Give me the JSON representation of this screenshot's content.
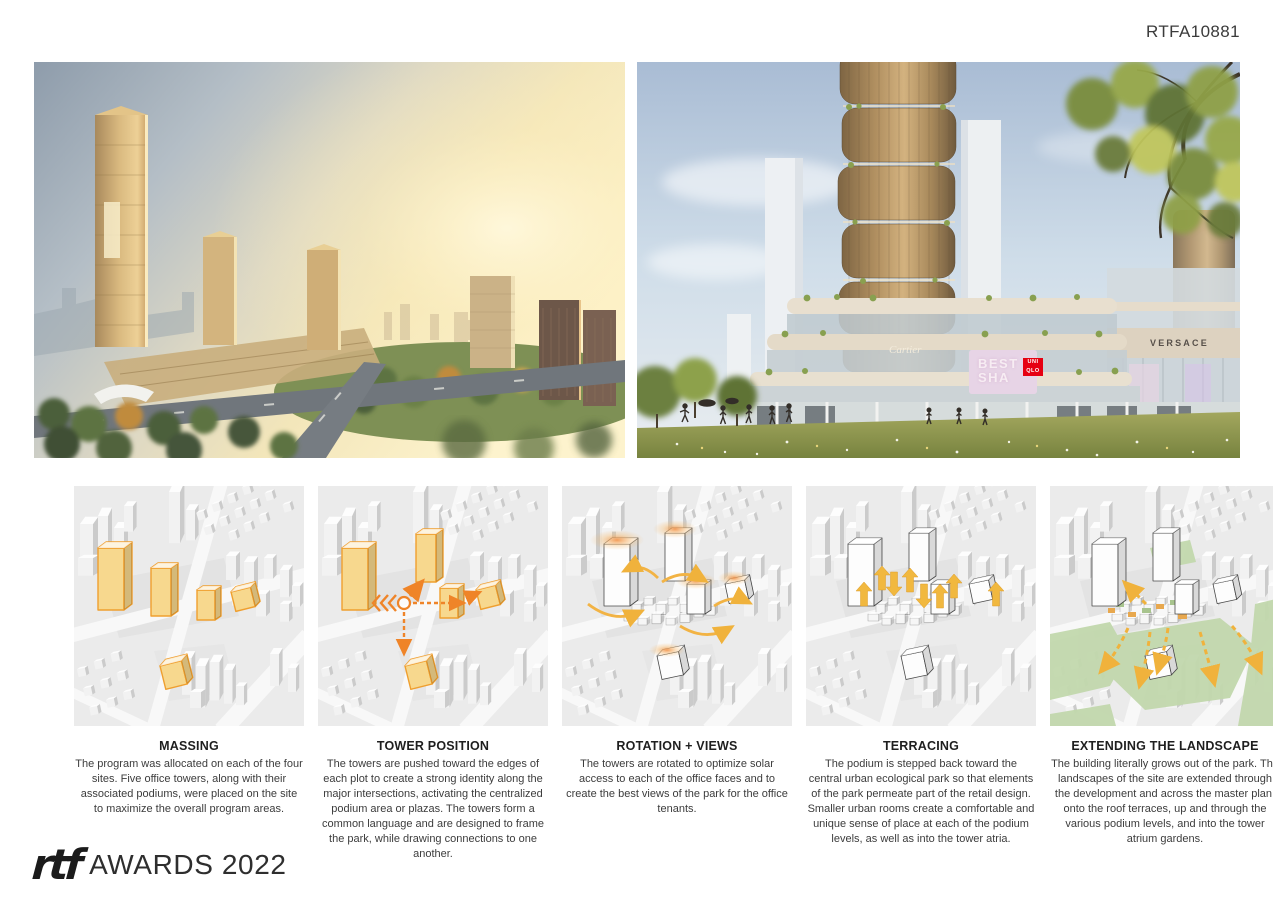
{
  "page": {
    "code": "RTFA10881"
  },
  "renderings": {
    "left": {
      "description": "aerial sunset masterplan rendering"
    },
    "right": {
      "description": "podium park rendering",
      "signs": {
        "versace": "VERSACE",
        "cartier": "Cartier",
        "led_line1": "BEST",
        "led_line2": "SHA",
        "uniqlo_top": "UNI",
        "uniqlo_bottom": "QLO"
      }
    }
  },
  "diagrams": [
    {
      "title": "MASSING",
      "body": "The program was allocated on each of the four sites. Five office towers, along with their associated podiums, were placed on the site to maximize the overall program areas."
    },
    {
      "title": "TOWER POSITION",
      "body": "The towers are pushed toward the edges of each plot to create a strong identity along the major intersections, activating the centralized podium area or plazas. The towers form a common language and are designed to frame the park, while drawing connections to one another."
    },
    {
      "title": "ROTATION + VIEWS",
      "body": "The towers are rotated to optimize solar access to each of the office faces and to create the best views of the park for the office tenants."
    },
    {
      "title": "TERRACING",
      "body": "The podium is stepped back toward the central urban ecological park so that elements of the park permeate part of the retail design. Smaller urban rooms create a comfortable and unique sense of place at each of the podium levels, as well as into the tower atria."
    },
    {
      "title": "EXTENDING THE LANDSCAPE",
      "body": "The building literally grows out of the park. The landscapes of the site are extended through the development and across the master plan, onto the roof terraces, up and through the various podium levels, and into the tower atrium gardens."
    }
  ],
  "footer": {
    "logo_text": "rtf",
    "awards_text": "AWARDS 2022"
  },
  "colors": {
    "accent_yellow": "#f3c04a",
    "accent_orange": "#ef8b2d",
    "diagram_green": "#c2d8ad",
    "diagram_bg": "#ececec"
  }
}
